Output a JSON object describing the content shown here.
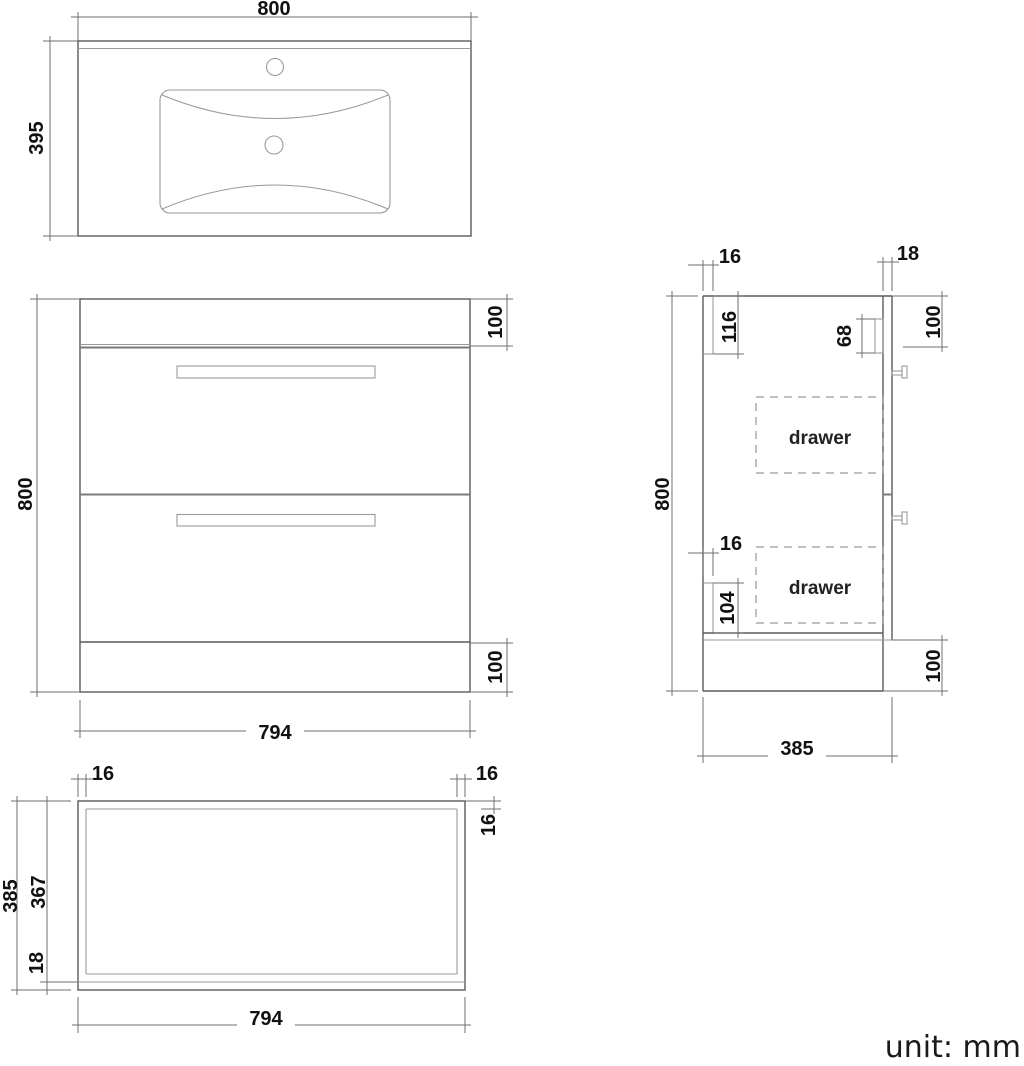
{
  "meta": {
    "unit_label": "unit: mm",
    "line_color": "#5a5a5a",
    "text_color": "#111111"
  },
  "top_view": {
    "width": "800",
    "depth": "395"
  },
  "front_view": {
    "height": "800",
    "top_rail_height": "100",
    "plinth_height": "100",
    "width": "794"
  },
  "side_view": {
    "back_panel_thickness": "16",
    "front_panel_thickness": "18",
    "back_rail_height": "116",
    "drawer_front_height": "68",
    "top_section_height": "100",
    "mid_panel_thickness": "16",
    "bottom_rail_height": "104",
    "plinth_height": "100",
    "height": "800",
    "depth": "385",
    "drawer_top_label": "drawer",
    "drawer_bottom_label": "drawer"
  },
  "plan_view": {
    "side_panel_left_thickness": "16",
    "side_panel_right_thickness": "16",
    "back_panel_thickness": "16",
    "depth": "385",
    "inner_depth": "367",
    "front_panel_thickness": "18",
    "width": "794"
  }
}
